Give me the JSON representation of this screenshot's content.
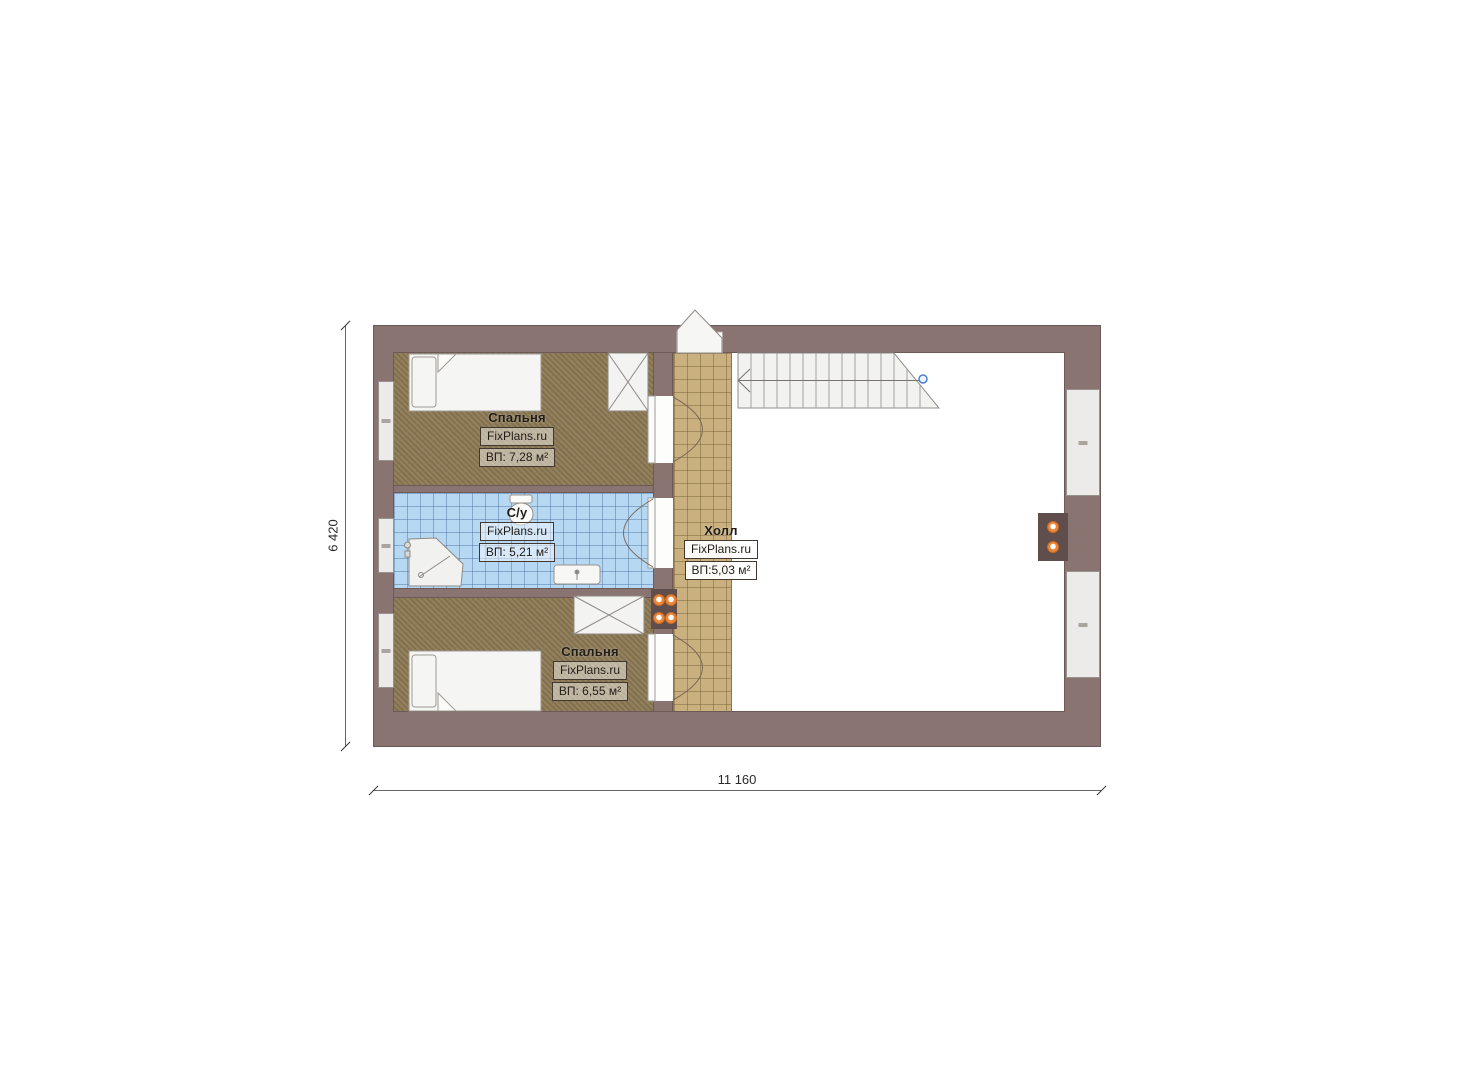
{
  "plan": {
    "brand": "FixPlans.ru",
    "rooms": {
      "bedroom_top": {
        "name": "Спальня",
        "brand": "FixPlans.ru",
        "area": "ВП: 7,28 м²"
      },
      "bathroom": {
        "name": "С/у",
        "brand": "FixPlans.ru",
        "area": "ВП: 5,21 м²"
      },
      "hall": {
        "name": "Холл",
        "brand": "FixPlans.ru",
        "area": "ВП:5,03 м²"
      },
      "bedroom_bottom": {
        "name": "Спальня",
        "brand": "FixPlans.ru",
        "area": "ВП: 6,55 м²"
      }
    },
    "dimensions": {
      "width": "11 160",
      "height": "6 420"
    }
  },
  "colors": {
    "wall": "#8a7471",
    "bedroom_floor": "#8c7954",
    "bathroom_floor": "#b6d8f2",
    "hall_floor": "#c9b07e",
    "stairs": "#f2f2f0",
    "window": "#ecebe9",
    "flue": "#5f4e4b",
    "accent_orange": "#ee8638",
    "marker_blue": "#4a7fd4"
  }
}
